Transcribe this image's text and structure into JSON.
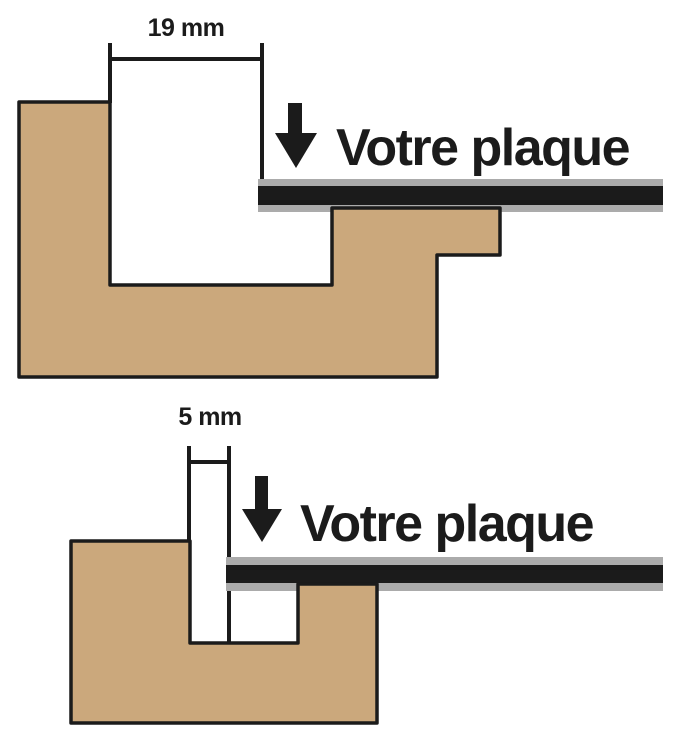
{
  "title": "Profil de cadre avec plaque",
  "colors": {
    "background": "#FFFFFF",
    "wood": "#CBA87C",
    "outline": "#1B1B1B",
    "plaque_gray": "#ABABAB",
    "plaque_dark": "#1B1B1B",
    "text": "#1B1B1B"
  },
  "labels": {
    "top": {
      "dimension": "19 mm",
      "plaque": "Votre plaque"
    },
    "bottom": {
      "dimension": "5 mm",
      "plaque": "Votre plaque"
    }
  },
  "measurements": {
    "top_rebate_mm": 19,
    "bottom_rebate_mm": 5
  },
  "shapes": [
    {
      "type": "rect",
      "name": "top-dim-line",
      "x": 110,
      "y": 57,
      "w": 152,
      "h": 4,
      "fill": "outline"
    },
    {
      "type": "rect",
      "name": "top-dim-tick-left",
      "x": 108,
      "y": 43,
      "w": 4,
      "h": 60,
      "fill": "outline"
    },
    {
      "type": "rect",
      "name": "top-dim-tick-right",
      "x": 260,
      "y": 43,
      "w": 4,
      "h": 137,
      "fill": "outline"
    },
    {
      "type": "rect",
      "name": "top-down-arrow-shaft",
      "x": 288,
      "y": 103,
      "w": 14,
      "h": 31,
      "fill": "outline"
    },
    {
      "type": "polygon",
      "name": "top-down-arrow-head",
      "points": "275,133 317,133 296,168",
      "fill": "outline"
    },
    {
      "type": "rect",
      "name": "top-plaque-upper-gray",
      "x": 258,
      "y": 179,
      "w": 405,
      "h": 7,
      "fill": "plaque_gray"
    },
    {
      "type": "rect",
      "name": "top-plaque-core",
      "x": 258,
      "y": 186,
      "w": 405,
      "h": 19,
      "fill": "plaque_dark"
    },
    {
      "type": "rect",
      "name": "top-plaque-lower-gray",
      "x": 258,
      "y": 205,
      "w": 405,
      "h": 7,
      "fill": "plaque_gray"
    },
    {
      "type": "path",
      "name": "top-frame-profile",
      "d": "M 19 102 L 110 102 L 110 285 L 332 285 L 332 208 L 500 208 L 500 255 L 437 255 L 437 377 L 19 377 Z",
      "fill": "wood",
      "stroke": "outline",
      "sw": 3.5
    },
    {
      "type": "rect",
      "name": "bottom-dim-line",
      "x": 189,
      "y": 460,
      "w": 40,
      "h": 4,
      "fill": "outline"
    },
    {
      "type": "rect",
      "name": "bottom-dim-tick-left",
      "x": 187,
      "y": 446,
      "w": 4,
      "h": 96,
      "fill": "outline"
    },
    {
      "type": "rect",
      "name": "bottom-dim-tick-right",
      "x": 227,
      "y": 446,
      "w": 4,
      "h": 197,
      "fill": "outline"
    },
    {
      "type": "rect",
      "name": "bottom-down-arrow-shaft",
      "x": 255,
      "y": 476,
      "w": 13,
      "h": 33,
      "fill": "outline"
    },
    {
      "type": "polygon",
      "name": "bottom-down-arrow-head",
      "points": "242,509 282,509 262,542",
      "fill": "outline"
    },
    {
      "type": "rect",
      "name": "bottom-plaque-upper-gray",
      "x": 226,
      "y": 557,
      "w": 437,
      "h": 8,
      "fill": "plaque_gray"
    },
    {
      "type": "rect",
      "name": "bottom-plaque-core",
      "x": 226,
      "y": 565,
      "w": 437,
      "h": 18,
      "fill": "plaque_dark"
    },
    {
      "type": "rect",
      "name": "bottom-plaque-lower-gray",
      "x": 226,
      "y": 583,
      "w": 437,
      "h": 8,
      "fill": "plaque_gray"
    },
    {
      "type": "path",
      "name": "bottom-frame-profile",
      "d": "M 71 541 L 190 541 L 190 643 L 298 643 L 298 584 L 377 584 L 377 723 L 71 723 Z",
      "fill": "wood",
      "stroke": "outline",
      "sw": 3.5
    }
  ]
}
